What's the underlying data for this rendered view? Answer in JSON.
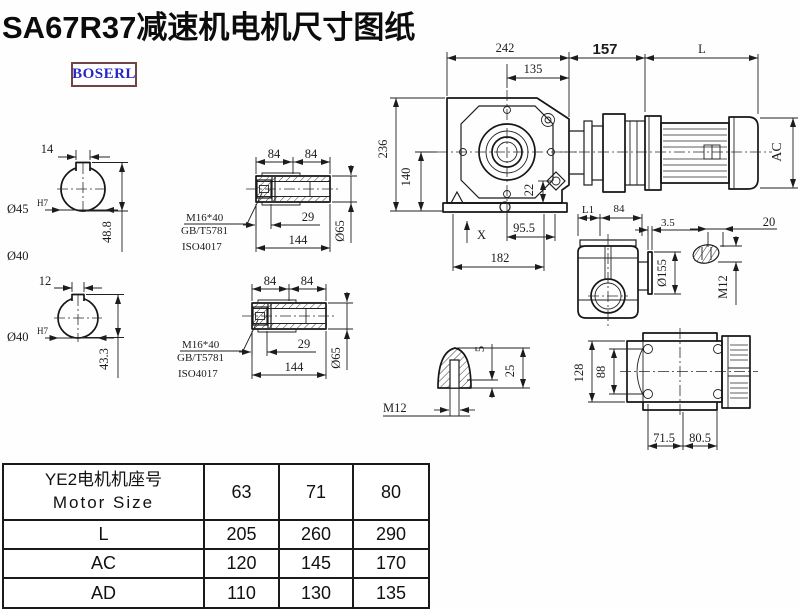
{
  "title": "SA67R37减速机电机尺寸图纸",
  "brand": "BOSERL",
  "colors": {
    "line": "#1c1c1c",
    "brand_text": "#2626c6",
    "brand_border": "#6e4444",
    "background": "#ffffff"
  },
  "shaft_a": {
    "key_width": "14",
    "bore": "Ø45",
    "bore_tol": "H7",
    "key_height": "48.8",
    "alt_label": "Ø40"
  },
  "shaft_b": {
    "key_width": "12",
    "bore": "Ø40",
    "bore_tol": "H7",
    "key_height": "43.3"
  },
  "bushing_a": {
    "len_left": "84",
    "len_right": "84",
    "bolt": "M16*40",
    "std_gb": "GB/T5781",
    "std_iso": "ISO4017",
    "depth": "29",
    "length": "144",
    "dia": "Ø65"
  },
  "bushing_b": {
    "len_left": "84",
    "len_right": "84",
    "bolt": "M16*40",
    "std_gb": "GB/T5781",
    "std_iso": "ISO4017",
    "depth": "29",
    "length": "144",
    "dia": "Ø65"
  },
  "front_view": {
    "width": "242",
    "width_inner": "135",
    "height": "236",
    "height_center": "140",
    "plug_offset": "22",
    "foot_a": "95.5",
    "foot_b": "182",
    "detail_mark": "X"
  },
  "assembly": {
    "gear_length": "157",
    "motor_length": "L",
    "motor_dia": "AC"
  },
  "flange_view": {
    "dim_l1": "L1",
    "dim_84": "84",
    "flange_thk": "3.5",
    "flange_dia": "Ø155"
  },
  "stud_detail": {
    "length": "20",
    "thread": "M12"
  },
  "bottom_view": {
    "height_total": "128",
    "height_inner": "88",
    "foot_left": "71.5",
    "foot_right": "80.5"
  },
  "plug_detail": {
    "dim_a": "5",
    "dim_b": "25",
    "thread": "M12"
  },
  "table": {
    "header_cn": "YE2电机机座号",
    "header_en": "Motor Size",
    "sizes": [
      "63",
      "71",
      "80"
    ],
    "rows": [
      {
        "label": "L",
        "values": [
          "205",
          "260",
          "290"
        ]
      },
      {
        "label": "AC",
        "values": [
          "120",
          "145",
          "170"
        ]
      },
      {
        "label": "AD",
        "values": [
          "110",
          "130",
          "135"
        ]
      }
    ]
  }
}
